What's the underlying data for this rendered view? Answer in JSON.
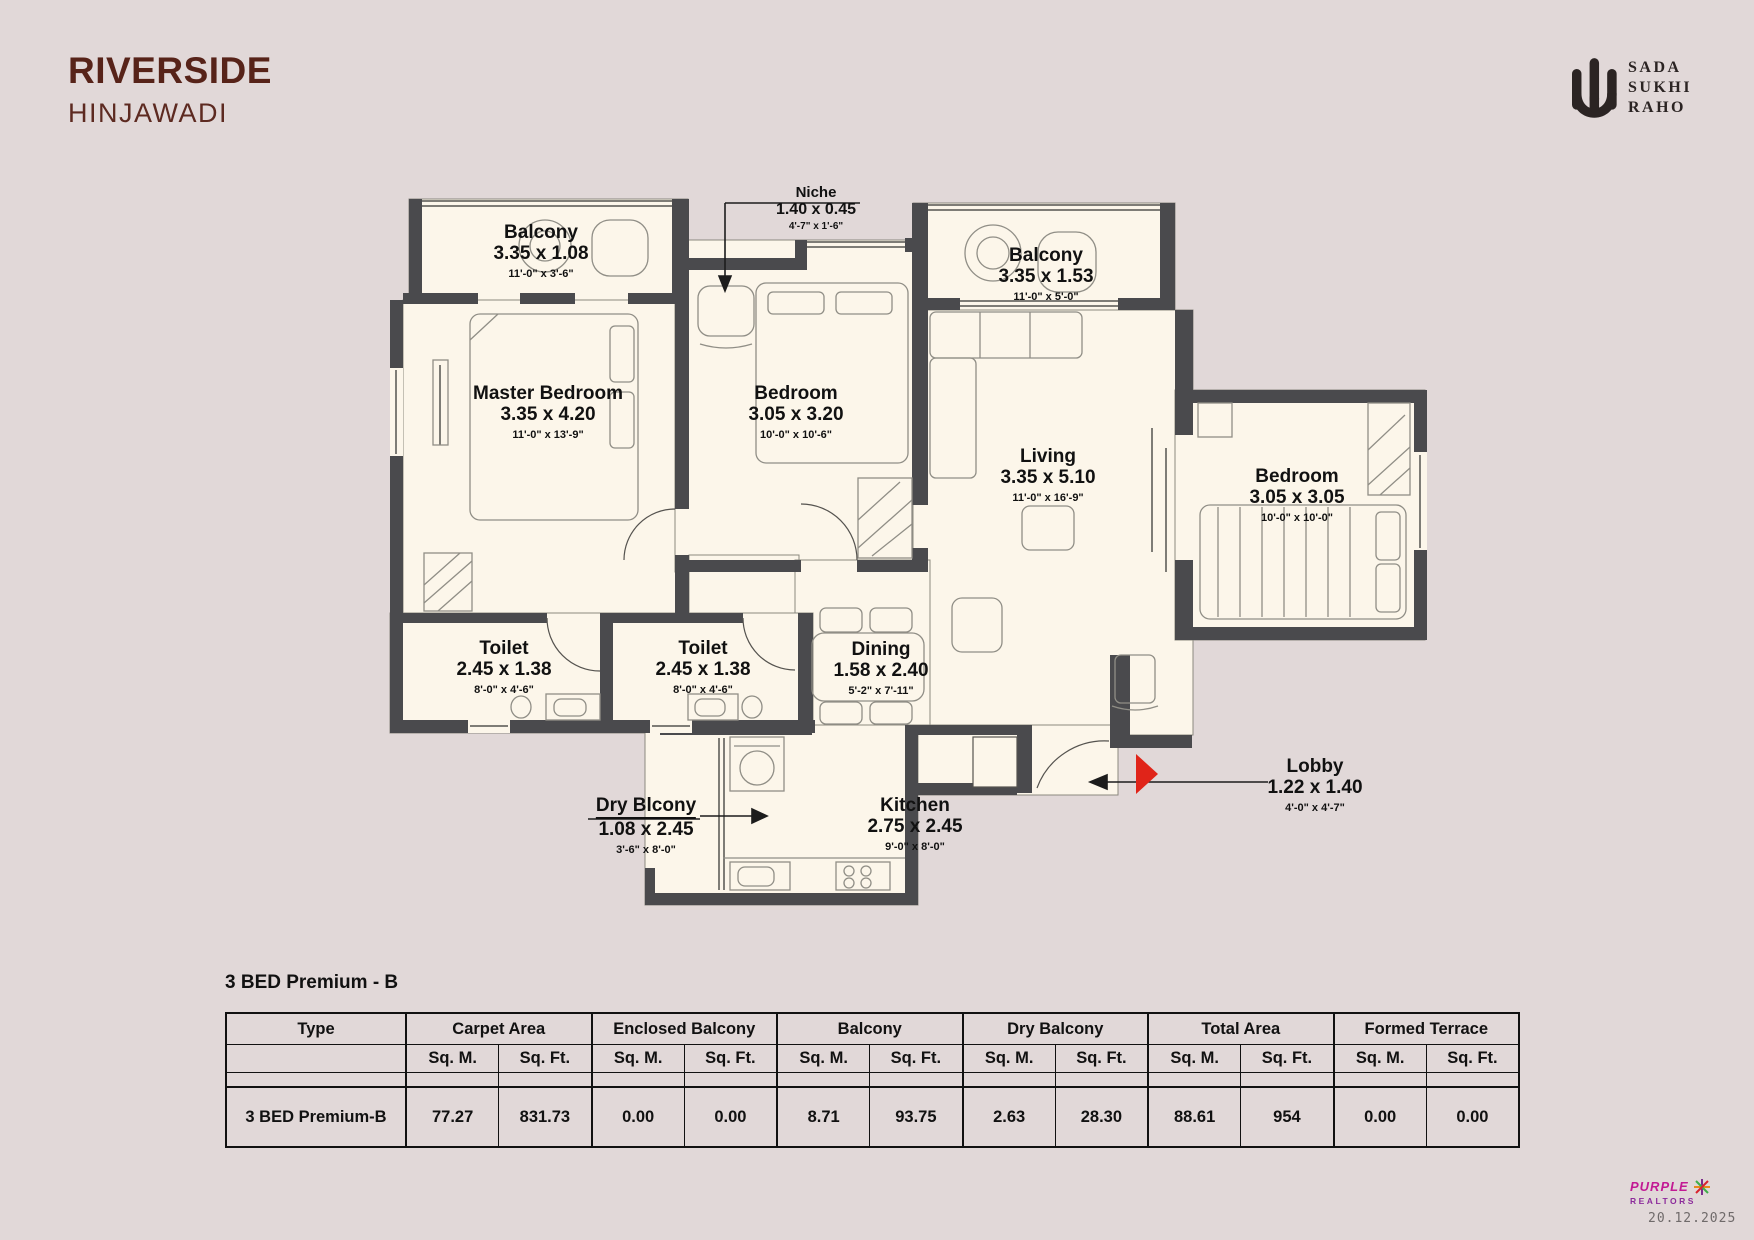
{
  "header": {
    "project": "RIVERSIDE",
    "location": "HINJAWADI",
    "logo_lines": [
      "SADA",
      "SUKHI",
      "RAHO"
    ]
  },
  "plan": {
    "rooms": [
      {
        "name": "Balcony",
        "metric": "3.35 x 1.08",
        "imperial": "11'-0\" x 3'-6\""
      },
      {
        "name": "Master Bedroom",
        "metric": "3.35 x 4.20",
        "imperial": "11'-0\" x 13'-9\""
      },
      {
        "name": "Bedroom",
        "metric": "3.05 x 3.20",
        "imperial": "10'-0\" x 10'-6\""
      },
      {
        "name": "Niche",
        "metric": "1.40 x 0.45",
        "imperial": "4'-7\" x 1'-6\""
      },
      {
        "name": "Balcony",
        "metric": "3.35 x 1.53",
        "imperial": "11'-0\" x 5'-0\""
      },
      {
        "name": "Living",
        "metric": "3.35 x 5.10",
        "imperial": "11'-0\" x 16'-9\""
      },
      {
        "name": "Bedroom",
        "metric": "3.05 x 3.05",
        "imperial": "10'-0\" x 10'-0\""
      },
      {
        "name": "Toilet",
        "metric": "2.45 x 1.38",
        "imperial": "8'-0\" x 4'-6\""
      },
      {
        "name": "Toilet",
        "metric": "2.45 x 1.38",
        "imperial": "8'-0\" x 4'-6\""
      },
      {
        "name": "Dining",
        "metric": "1.58 x 2.40",
        "imperial": "5'-2\" x 7'-11\""
      },
      {
        "name": "Dry Blcony",
        "metric": "1.08 x 2.45",
        "imperial": "3'-6\" x 8'-0\""
      },
      {
        "name": "Kitchen",
        "metric": "2.75 x 2.45",
        "imperial": "9'-0\" x 8'-0\""
      },
      {
        "name": "Lobby",
        "metric": "1.22 x 1.40",
        "imperial": "4'-0\" x 4'-7\""
      }
    ]
  },
  "table": {
    "title": "3 BED Premium - B",
    "columns": [
      "Type",
      "Carpet Area",
      "Enclosed Balcony",
      "Balcony",
      "Dry Balcony",
      "Total Area",
      "Formed Terrace"
    ],
    "units": [
      "Sq. M.",
      "Sq. Ft."
    ],
    "row": {
      "label": "3 BED Premium-B",
      "values": [
        "77.27",
        "831.73",
        "0.00",
        "0.00",
        "8.71",
        "93.75",
        "2.63",
        "28.30",
        "88.61",
        "954",
        "0.00",
        "0.00"
      ]
    }
  },
  "footer": {
    "brand_line1": "PURPLE",
    "brand_line2": "REALTORS",
    "date": "20.12.2025"
  }
}
